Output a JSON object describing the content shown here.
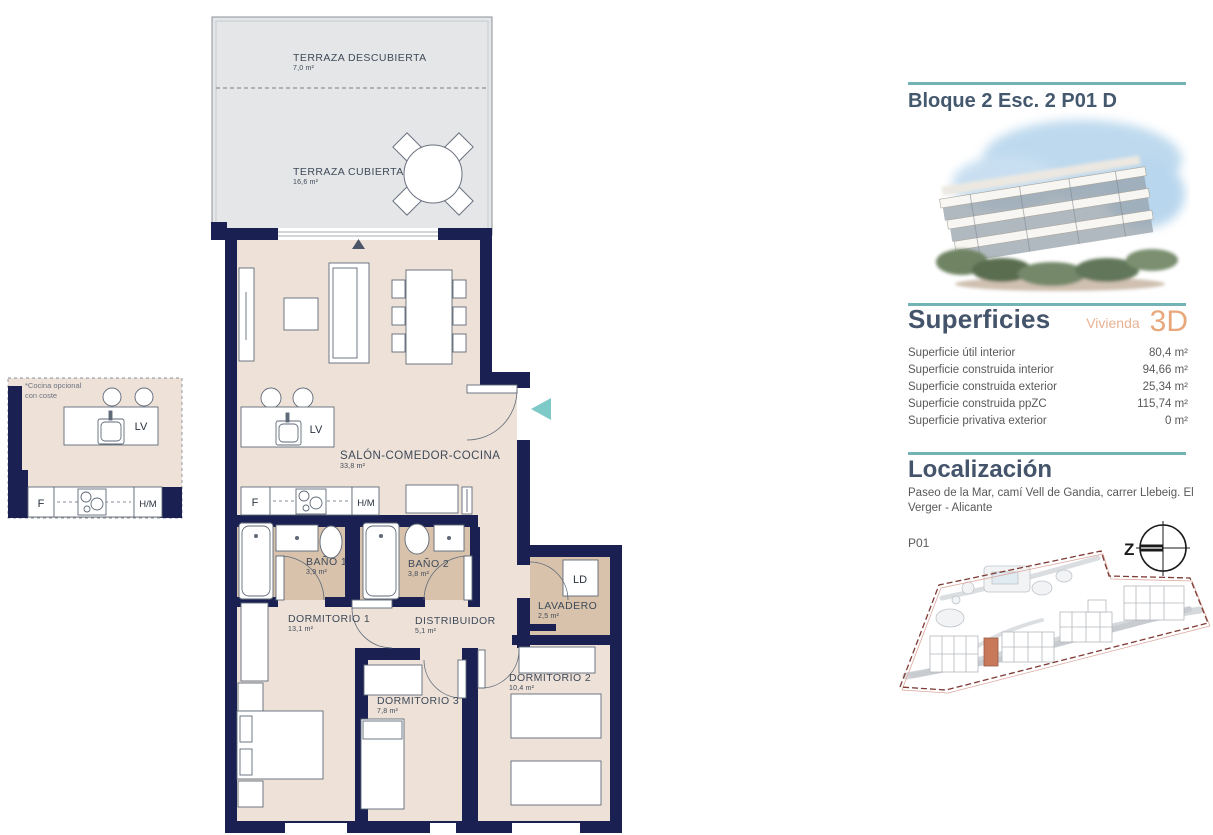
{
  "floor_plan": {
    "rooms": [
      {
        "name": "TERRAZA DESCUBIERTA",
        "area": "7,0 m²"
      },
      {
        "name": "TERRAZA CUBIERTA",
        "area": "16,6 m²"
      },
      {
        "name": "SALÓN-COMEDOR-COCINA",
        "area": "33,8 m²"
      },
      {
        "name": "BAÑO 1",
        "area": "3,9 m²"
      },
      {
        "name": "BAÑO 2",
        "area": "3,8 m²"
      },
      {
        "name": "DORMITORIO 1",
        "area": "13,1 m²"
      },
      {
        "name": "DISTRIBUIDOR",
        "area": "5,1 m²"
      },
      {
        "name": "LAVADERO",
        "area": "2,5 m²"
      },
      {
        "name": "DORMITORIO 2",
        "area": "10,4 m²"
      },
      {
        "name": "DORMITORIO 3",
        "area": "7,8 m²"
      }
    ],
    "labels": {
      "lv": "LV",
      "f": "F",
      "hm": "H/M",
      "ld": "LD"
    },
    "optional_kitchen_note_line1": "*Cocina opcional",
    "optional_kitchen_note_line2": "con coste"
  },
  "sidebar": {
    "title": "Bloque 2 Esc. 2 P01 D",
    "superficies": {
      "heading": "Superficies",
      "vivienda_label": "Vivienda",
      "threed_label": "3D",
      "rows": [
        {
          "label": "Superficie útil interior",
          "value": "80,4 m²"
        },
        {
          "label": "Superficie construida interior",
          "value": "94,66 m²"
        },
        {
          "label": "Superficie construida exterior",
          "value": "25,34 m²"
        },
        {
          "label": "Superficie construida ppZC",
          "value": "115,74 m²"
        },
        {
          "label": "Superficie privativa exterior",
          "value": "0 m²"
        }
      ]
    },
    "localizacion": {
      "heading": "Localización",
      "address": "Paseo de la Mar, camí Vell de Gandia, carrer Llebeig. El Verger - Alicante",
      "plan_level": "P01",
      "compass_letter": "Z"
    }
  },
  "colors": {
    "wall_navy": "#1a2152",
    "floor_beige": "#eee1d8",
    "floor_tan": "#d8c2ab",
    "terrace_gray": "#e5e6e7",
    "accent_teal": "#74b3b5",
    "entrance_arrow_teal": "#7ecac9",
    "accent_orange": "#e8a87c",
    "heading_slate": "#44546a",
    "site_boundary_red": "#7e3b35",
    "site_highlight_orange": "#c8795a"
  }
}
